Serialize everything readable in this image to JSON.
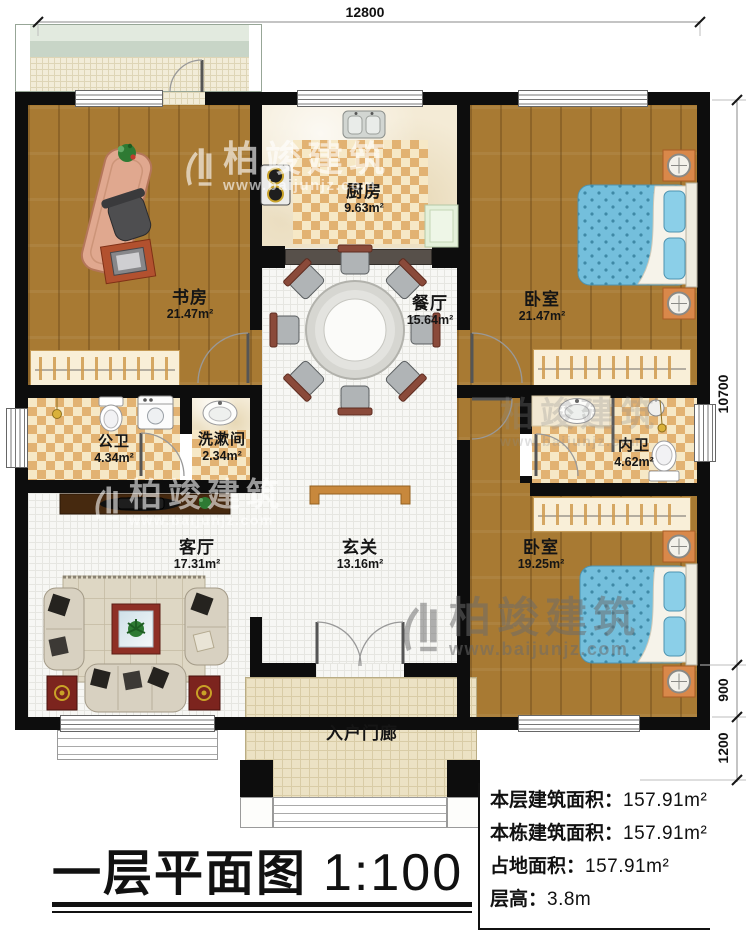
{
  "title": {
    "main": "一层平面图",
    "scale": "1:100"
  },
  "summary": [
    {
      "label": "本层建筑面积：",
      "value": "157.91m²"
    },
    {
      "label": "本栋建筑面积：",
      "value": "157.91m²"
    },
    {
      "label": "占地面积：",
      "value": "157.91m²"
    },
    {
      "label": "层高：",
      "value": "3.8m"
    }
  ],
  "dimensions": {
    "top": "12800",
    "right_main": "10700",
    "right_upper": "900",
    "right_lower": "1200"
  },
  "rooms": [
    {
      "id": "study",
      "name": "书房",
      "area": "21.47m²"
    },
    {
      "id": "kitchen",
      "name": "厨房",
      "area": "9.63m²"
    },
    {
      "id": "dining",
      "name": "餐厅",
      "area": "15.64m²"
    },
    {
      "id": "bedroom1",
      "name": "卧室",
      "area": "21.47m²"
    },
    {
      "id": "bath-public",
      "name": "公卫",
      "area": "4.34m²"
    },
    {
      "id": "washroom",
      "name": "洗漱间",
      "area": "2.34m²"
    },
    {
      "id": "bath-inner",
      "name": "内卫",
      "area": "4.62m²"
    },
    {
      "id": "living",
      "name": "客厅",
      "area": "17.31m²"
    },
    {
      "id": "foyer",
      "name": "玄关",
      "area": "13.16m²"
    },
    {
      "id": "bedroom2",
      "name": "卧室",
      "area": "19.25m²"
    },
    {
      "id": "porch",
      "name": "入户门廊",
      "area": ""
    }
  ],
  "watermark": {
    "name": "柏竣建筑",
    "url": "www.baijunjz.com"
  },
  "colors": {
    "wall": "#0d0d0d",
    "wood": "#a87a33",
    "checker": "#e2b272",
    "bed_blue": "#74bfdc",
    "nightstand_orange": "#d9884a",
    "console_tan": "#c8883c"
  }
}
